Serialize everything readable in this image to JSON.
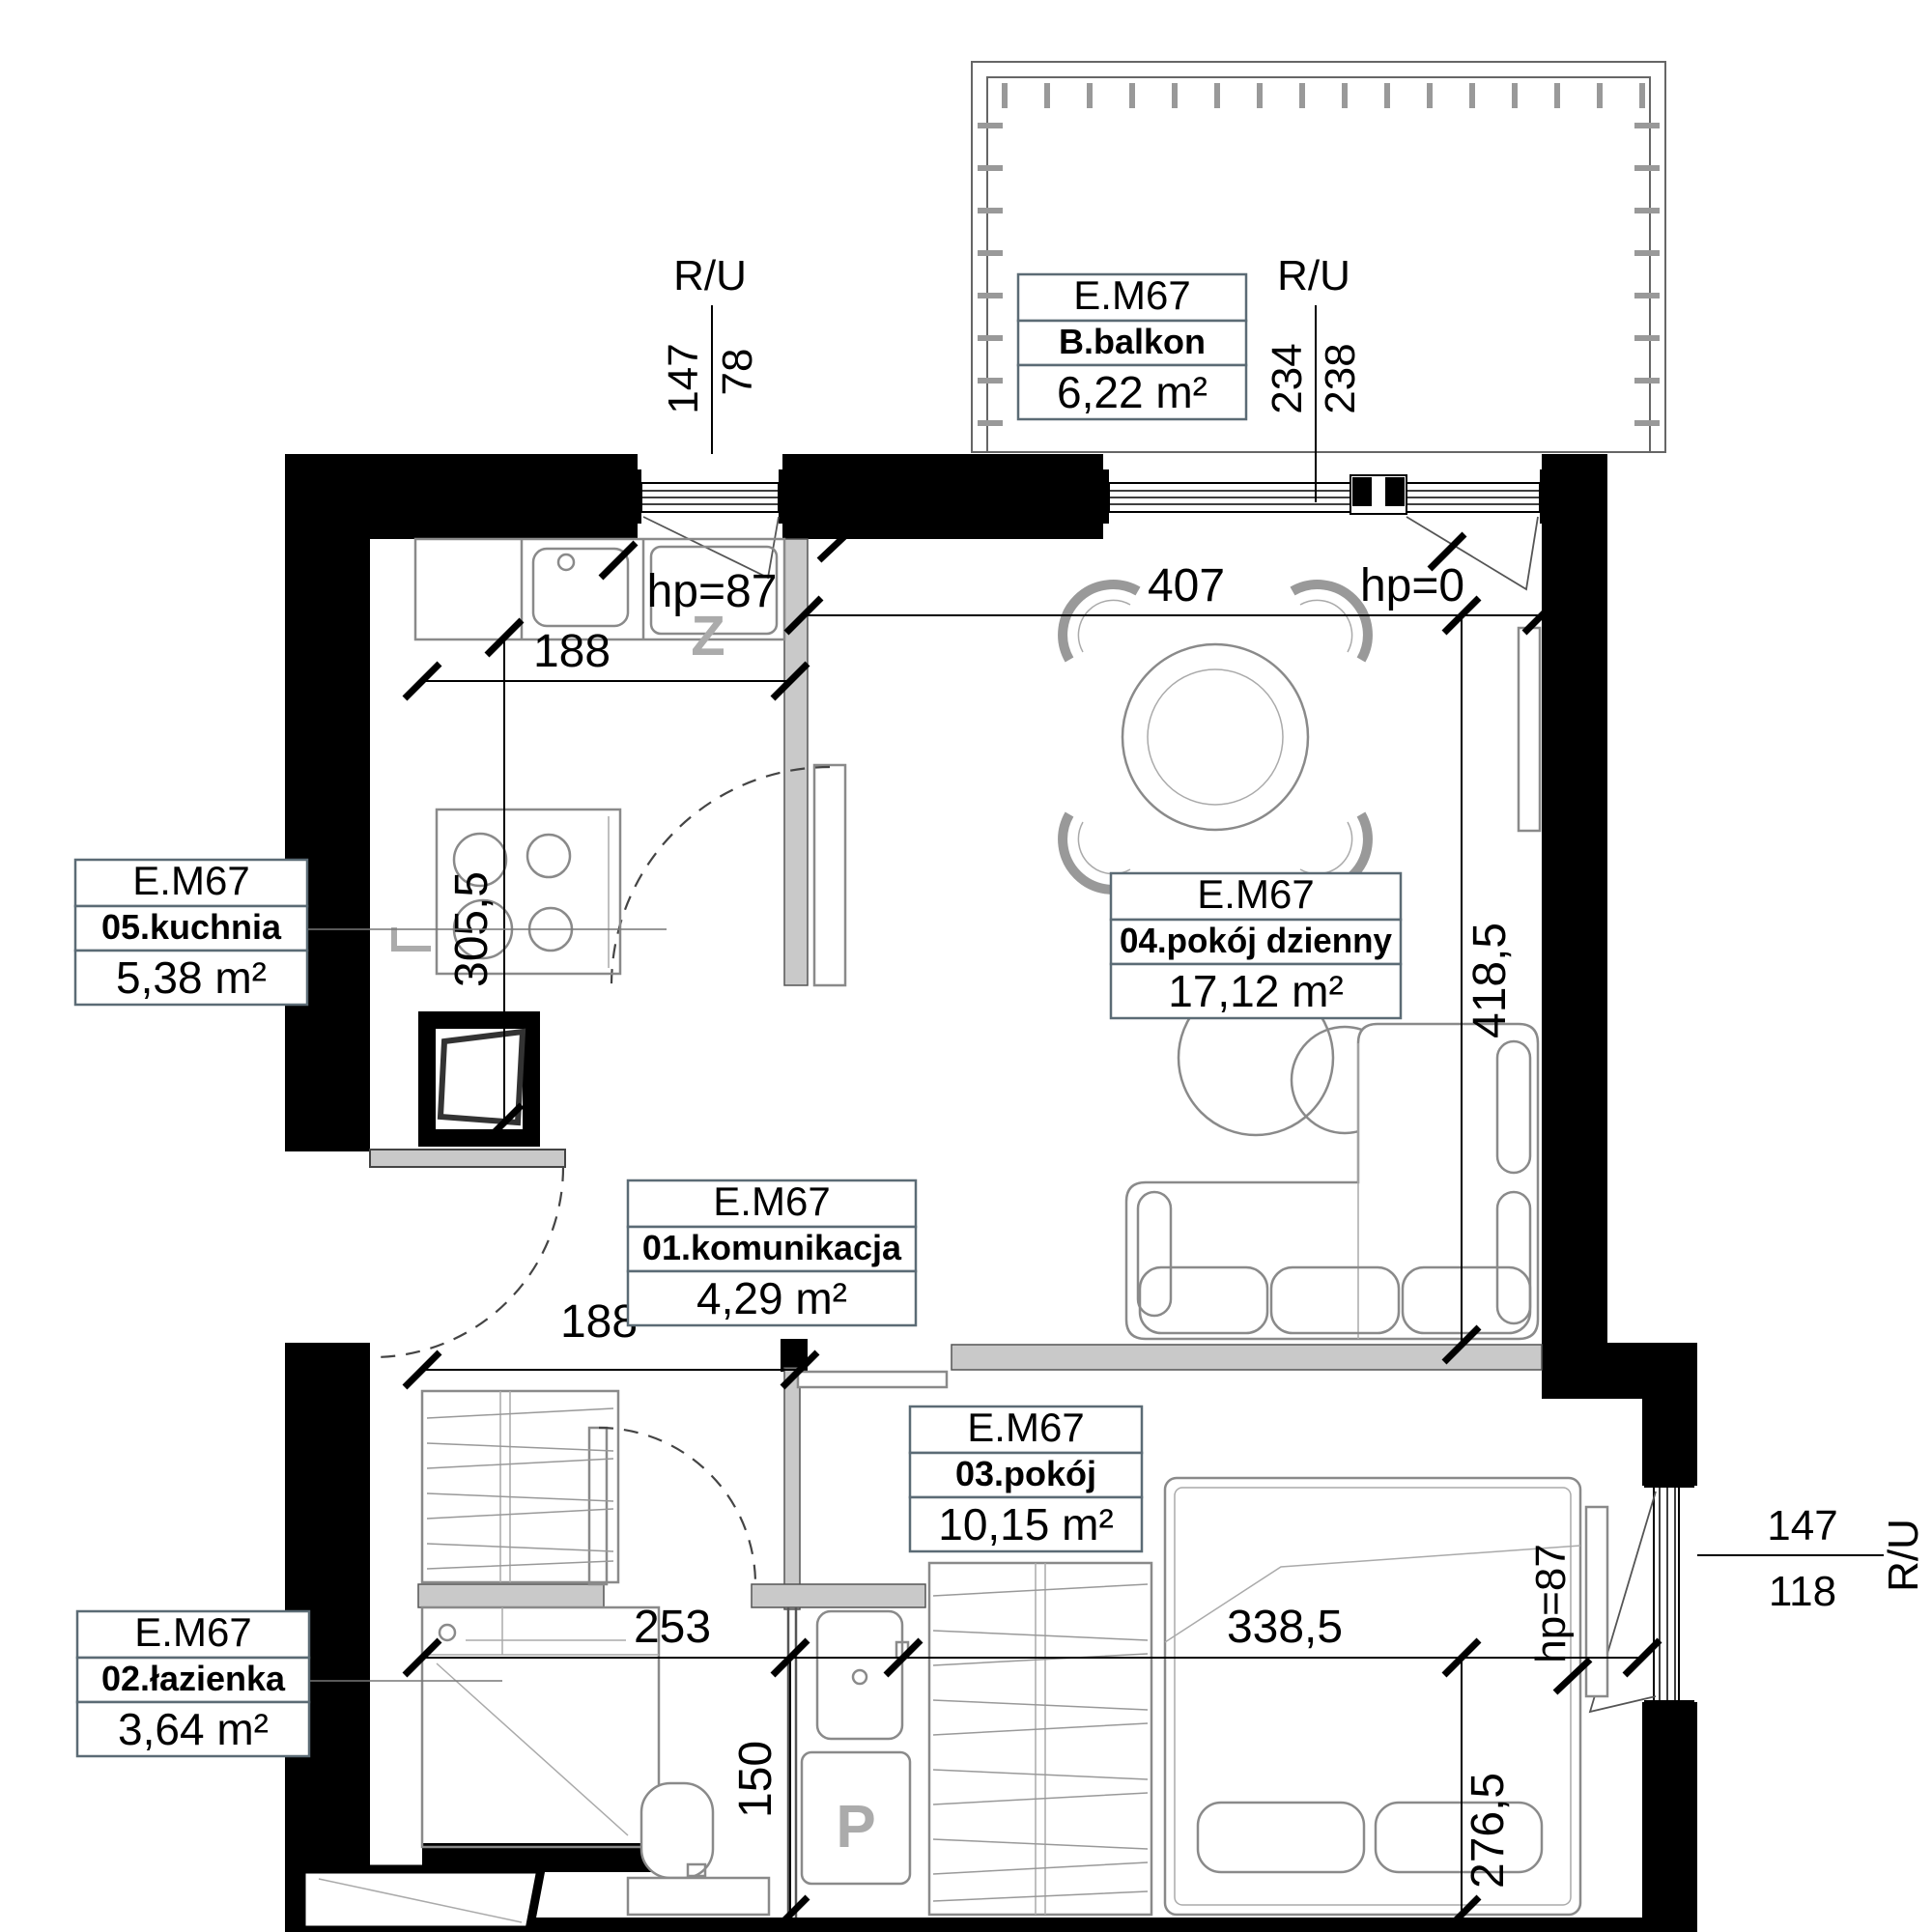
{
  "plan_code": "E.M67",
  "rooms": {
    "balkon": {
      "code": "E.M67",
      "name": "B.balkon",
      "area": "6,22 m²"
    },
    "komunikacja": {
      "code": "E.M67",
      "name": "01.komunikacja",
      "area": "4,29 m²"
    },
    "lazienka": {
      "code": "E.M67",
      "name": "02.łazienka",
      "area": "3,64 m²"
    },
    "pokoj": {
      "code": "E.M67",
      "name": "03.pokój",
      "area": "10,15 m²"
    },
    "pokoj_dzienny": {
      "code": "E.M67",
      "name": "04.pokój dzienny",
      "area": "17,12 m²"
    },
    "kuchnia": {
      "code": "E.M67",
      "name": "05.kuchnia",
      "area": "5,38 m²"
    }
  },
  "dimensions": {
    "ru_top_left": {
      "label": "R/U",
      "width": "147",
      "height": "78"
    },
    "ru_balcony": {
      "label": "R/U",
      "width": "234",
      "height": "238"
    },
    "ru_bedroom": {
      "label": "R/U",
      "width": "147",
      "height": "118"
    },
    "living_width": "407",
    "living_door_sill": "hp=0",
    "kitchen_counter_width": "188",
    "kitchen_depth": "305,5",
    "living_depth": "418,5",
    "hall_width": "188",
    "bath_width": "253",
    "bath_strip_depth": "150",
    "bedroom_width": "338,5",
    "bedroom_depth": "276,5",
    "kitchen_window_sill": "hp=87",
    "bedroom_window_sill": "hp=87"
  },
  "symbols": {
    "fridge": "Z",
    "washer": "P"
  }
}
